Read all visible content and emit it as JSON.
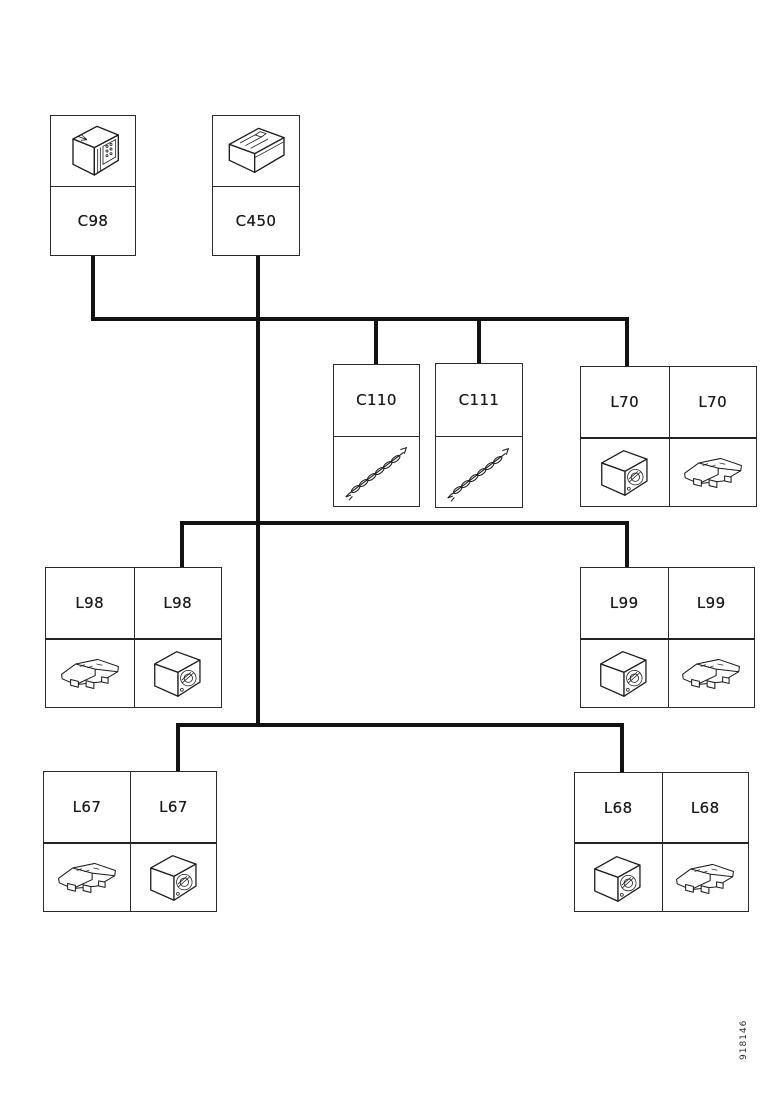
{
  "page": {
    "type": "component-location-network-diagram",
    "background_color": "#ffffff",
    "line_color": "#121212"
  },
  "figure_number": "918146",
  "nodes": [
    {
      "id": "C98",
      "label": "C98",
      "drawing": "control-unit-drawing"
    },
    {
      "id": "C450",
      "label": "C450",
      "drawing": "relay-module-drawing"
    },
    {
      "id": "C110",
      "label": "C110",
      "drawing": "wiring-harness-drawing"
    },
    {
      "id": "C111",
      "label": "C111",
      "drawing": "wiring-harness-drawing"
    },
    {
      "id": "L70",
      "labels": [
        "L70",
        "L70"
      ],
      "drawings": [
        "lamp-unit-drawing",
        "lamp-bracket-drawing"
      ]
    },
    {
      "id": "L98",
      "labels": [
        "L98",
        "L98"
      ],
      "drawings": [
        "lamp-bracket-drawing",
        "lamp-unit-drawing"
      ]
    },
    {
      "id": "L99",
      "labels": [
        "L99",
        "L99"
      ],
      "drawings": [
        "lamp-unit-drawing",
        "lamp-bracket-drawing"
      ]
    },
    {
      "id": "L67",
      "labels": [
        "L67",
        "L67"
      ],
      "drawings": [
        "lamp-bracket-drawing",
        "lamp-unit-drawing"
      ]
    },
    {
      "id": "L68",
      "labels": [
        "L68",
        "L68"
      ],
      "drawings": [
        "lamp-unit-drawing",
        "lamp-bracket-drawing"
      ]
    }
  ],
  "buses": [
    {
      "name": "bus-1",
      "connects": [
        "C98",
        "C450",
        "C110",
        "C111",
        "L70"
      ]
    },
    {
      "name": "bus-2",
      "connects": [
        "C450",
        "L98",
        "L99"
      ]
    },
    {
      "name": "bus-3",
      "connects": [
        "C450",
        "L67",
        "L68"
      ]
    }
  ]
}
